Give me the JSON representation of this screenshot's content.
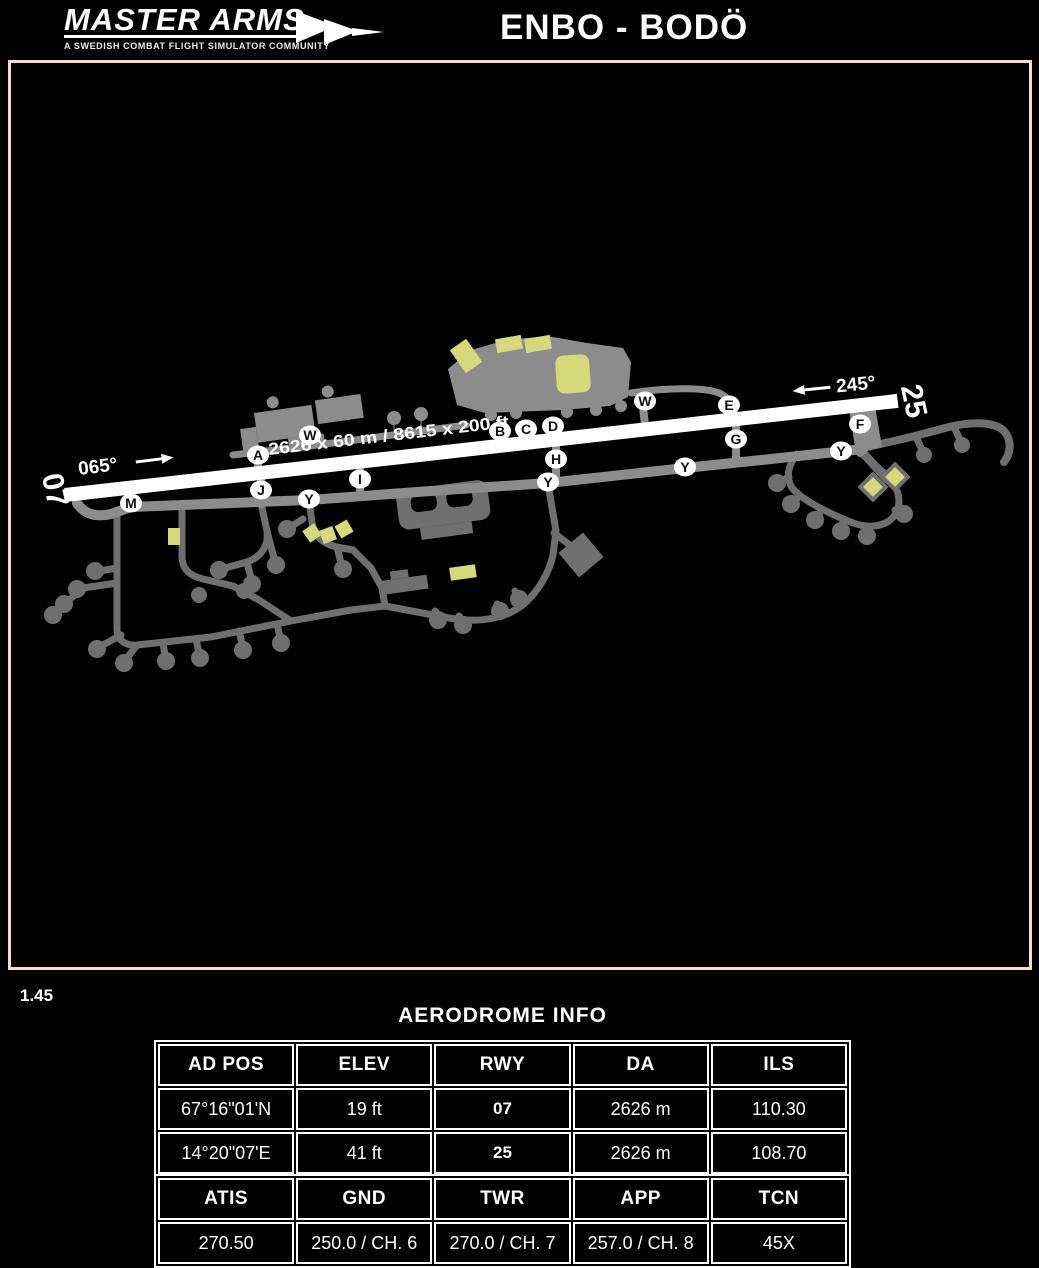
{
  "header": {
    "logo_title": "MASTER ARMS",
    "logo_tagline": "A SWEDISH COMBAT FLIGHT SIMULATOR COMMUNITY",
    "title": "ENBO - BODÖ"
  },
  "page_number": "1.45",
  "map": {
    "texts": {
      "rwy_left": "07",
      "rwy_right": "25",
      "heading_left": "065°",
      "heading_right": "245°",
      "runway_dims": "2626 x 60 m / 8615 x 200 ft"
    },
    "taxiway_labels": [
      {
        "text": "A",
        "x": 247,
        "y": 392
      },
      {
        "text": "W",
        "x": 299,
        "y": 372
      },
      {
        "text": "B",
        "x": 489,
        "y": 368
      },
      {
        "text": "C",
        "x": 515,
        "y": 366
      },
      {
        "text": "D",
        "x": 542,
        "y": 363
      },
      {
        "text": "W",
        "x": 634,
        "y": 338
      },
      {
        "text": "E",
        "x": 718,
        "y": 342
      },
      {
        "text": "F",
        "x": 849,
        "y": 361
      },
      {
        "text": "G",
        "x": 725,
        "y": 376
      },
      {
        "text": "H",
        "x": 545,
        "y": 396
      },
      {
        "text": "I",
        "x": 349,
        "y": 416
      },
      {
        "text": "J",
        "x": 250,
        "y": 427
      },
      {
        "text": "M",
        "x": 120,
        "y": 440
      },
      {
        "text": "Y",
        "x": 298,
        "y": 436
      },
      {
        "text": "Y",
        "x": 537,
        "y": 419
      },
      {
        "text": "Y",
        "x": 674,
        "y": 404
      },
      {
        "text": "Y",
        "x": 830,
        "y": 388
      }
    ],
    "colors": {
      "frame_border": "#fbdcca",
      "runway": "#ffffff",
      "taxiway": "#8c8c8c",
      "south_taxiway": "#6f6f6f",
      "building": "#d5d97a"
    }
  },
  "aerodrome_info": {
    "title": "AERODROME INFO",
    "table1": {
      "headers": [
        "AD POS",
        "ELEV",
        "RWY",
        "DA",
        "ILS"
      ],
      "rows": [
        [
          "67°16\"01'N",
          "19 ft",
          "07",
          "2626 m",
          "110.30"
        ],
        [
          "14°20\"07'E",
          "41 ft",
          "25",
          "2626 m",
          "108.70"
        ]
      ]
    },
    "table2": {
      "headers": [
        "ATIS",
        "GND",
        "TWR",
        "APP",
        "TCN"
      ],
      "rows": [
        [
          "270.50",
          "250.0 / CH. 6",
          "270.0 / CH. 7",
          "257.0 / CH. 8",
          "45X"
        ]
      ]
    }
  }
}
